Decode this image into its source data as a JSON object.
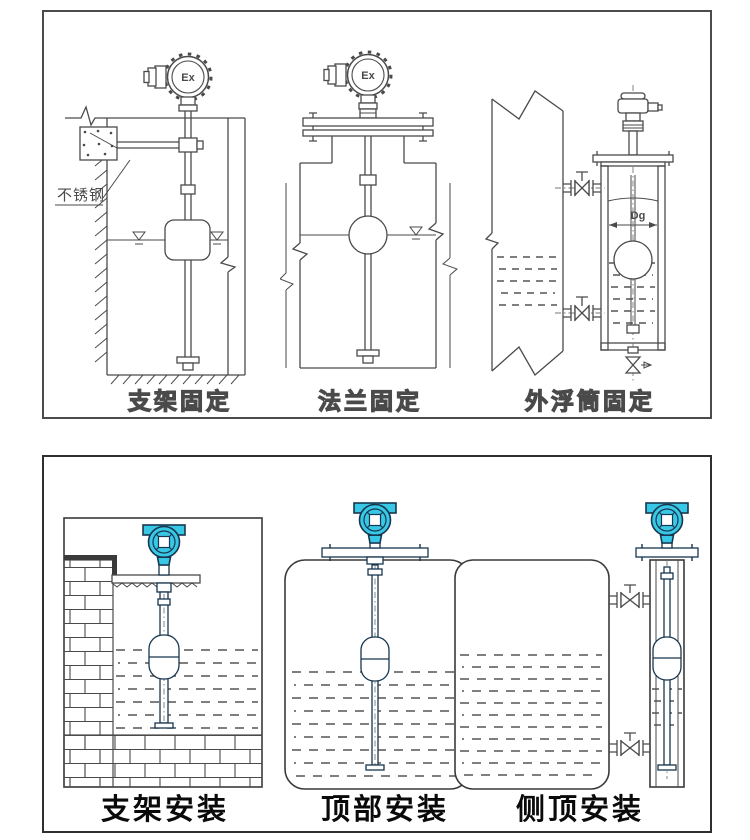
{
  "panels": {
    "top": {
      "figures": [
        {
          "id": "bracket-fixing",
          "caption": "支架固定",
          "labels": {
            "head": "Ex",
            "material": "不锈钢"
          }
        },
        {
          "id": "flange-fixing",
          "caption": "法兰固定",
          "labels": {
            "head": "Ex"
          }
        },
        {
          "id": "external-chamber-fixing",
          "caption": "外浮筒固定",
          "labels": {
            "diameter": "Dg"
          }
        }
      ]
    },
    "bottom": {
      "figures": [
        {
          "id": "bracket-mounting",
          "caption": "支架安装"
        },
        {
          "id": "top-mounting",
          "caption": "顶部安装"
        },
        {
          "id": "side-top-mounting",
          "caption": "侧顶安装"
        }
      ]
    }
  },
  "colors": {
    "background": "#ffffff",
    "line_art": "#4a4a4a",
    "panel_border_top": "#4b4b4b",
    "panel_border_bottom": "#2f2f2f",
    "transmitter_head_fill": "#38c8e6",
    "transmitter_head_outline": "#17364f",
    "water_dash": "#555555",
    "caption_top_color": "#4a4a4a",
    "caption_bottom_color": "#0a0a0a"
  }
}
